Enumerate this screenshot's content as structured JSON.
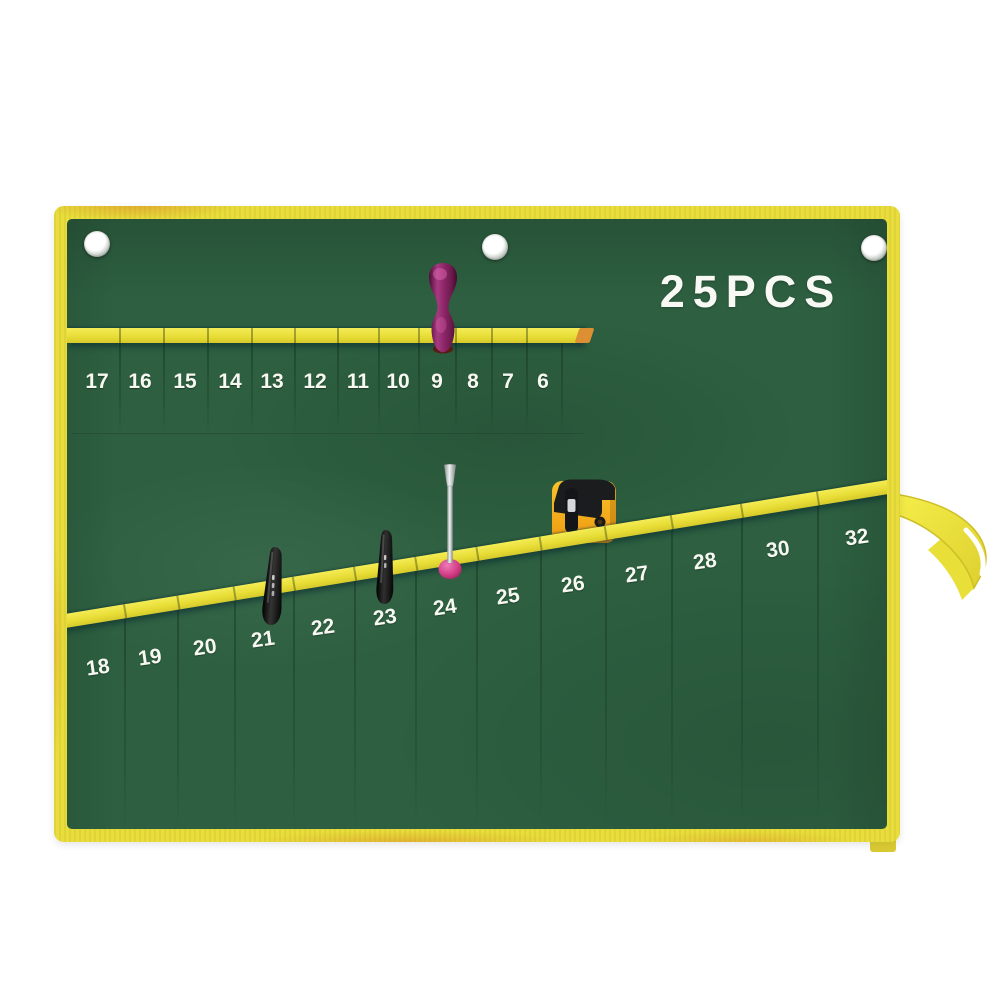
{
  "image": {
    "type": "product-photo",
    "subject": "canvas roll-up tool pouch with numbered pockets",
    "label": "25PCS",
    "pockets": {
      "top_row_labels": [
        "17",
        "16",
        "15",
        "14",
        "13",
        "12",
        "11",
        "10",
        "9",
        "8",
        "7",
        "6"
      ],
      "bottom_row_labels": [
        "18",
        "19",
        "20",
        "21",
        "22",
        "23",
        "24",
        "25",
        "26",
        "27",
        "28",
        "30",
        "32"
      ]
    },
    "grommet_count": 3,
    "tools": [
      {
        "name": "wooden-handle-screwdriver",
        "color": "purple"
      },
      {
        "name": "black-mini-tool-left",
        "color": "black"
      },
      {
        "name": "black-mini-tool-right",
        "color": "black"
      },
      {
        "name": "slotted-screwdriver",
        "color": "silver-pink"
      },
      {
        "name": "utility-knife",
        "color": "yellow-black"
      },
      {
        "name": "tie-strap",
        "color": "yellow"
      }
    ],
    "colors": {
      "canvas_green": "#2d5f40",
      "trim_yellow": "#e8dd3b",
      "trim_orange": "#dd8f33",
      "number_text": "#f7f8f2"
    }
  }
}
